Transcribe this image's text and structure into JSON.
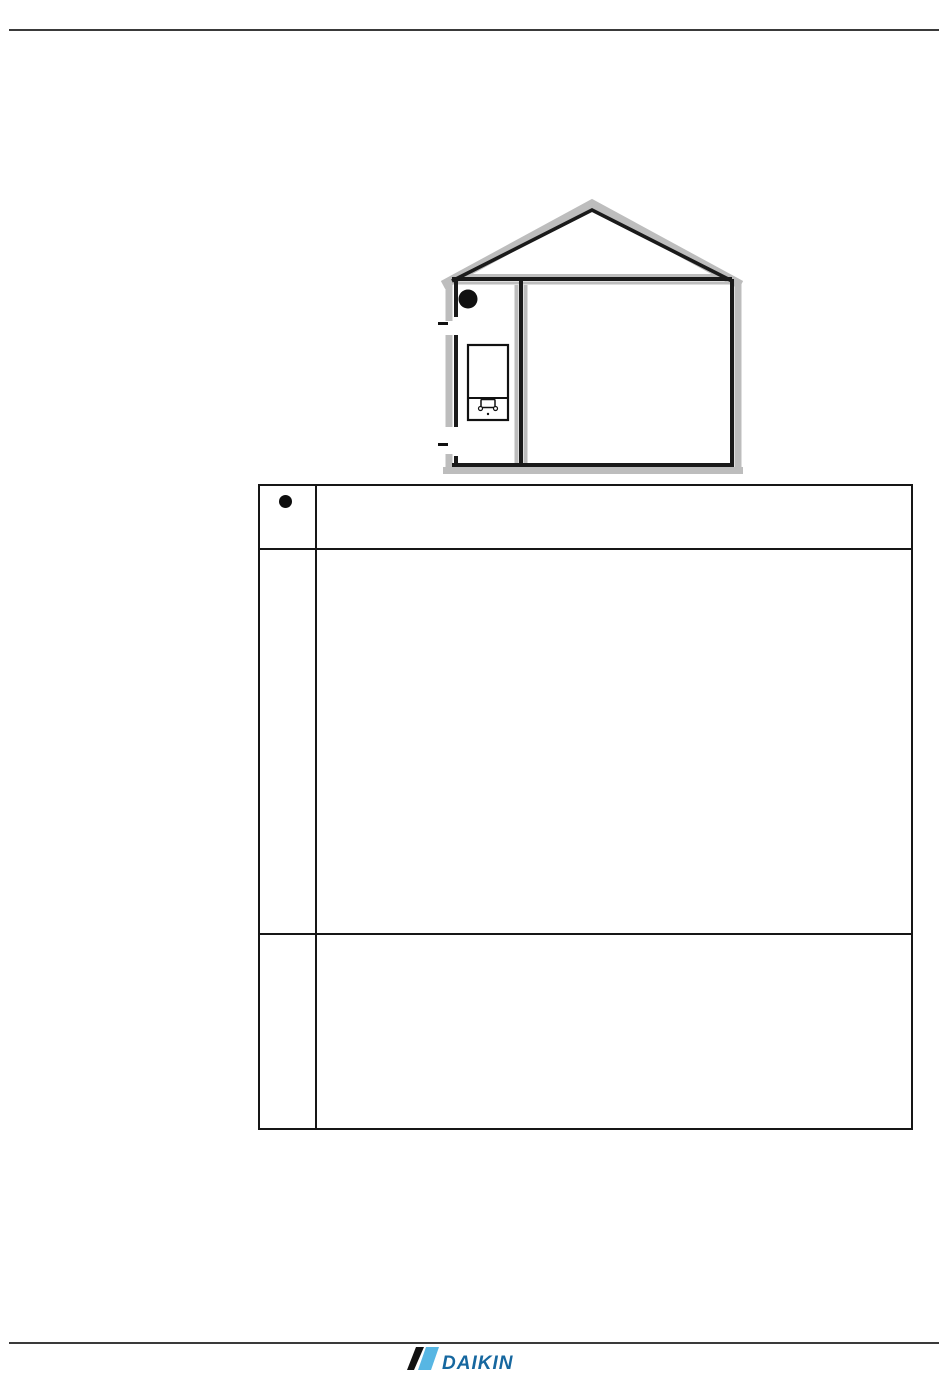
{
  "page": {
    "background": "#ffffff",
    "rule_color": "#3a3a3a"
  },
  "diagram": {
    "type": "house-cross-section",
    "outline_color": "#1a1a1a",
    "shadow_color": "#bdbdbd",
    "marker_style": "filled-circle",
    "marker_color": "#111111",
    "elements": [
      "roof",
      "ceiling",
      "left-room",
      "main-room",
      "indoor-unit",
      "wall-openings",
      "position-marker"
    ]
  },
  "table": {
    "border_color": "#161616",
    "columns": [
      "marker",
      "description"
    ],
    "rows": [
      {
        "marker": "filled-circle",
        "description": ""
      },
      {
        "marker": "",
        "description": ""
      },
      {
        "marker": "",
        "description": ""
      }
    ]
  },
  "footer": {
    "logo_text": "DAIKIN",
    "logo_text_color": "#16679F",
    "logo_flag_black": "#111111",
    "logo_flag_blue": "#57B6E3"
  }
}
